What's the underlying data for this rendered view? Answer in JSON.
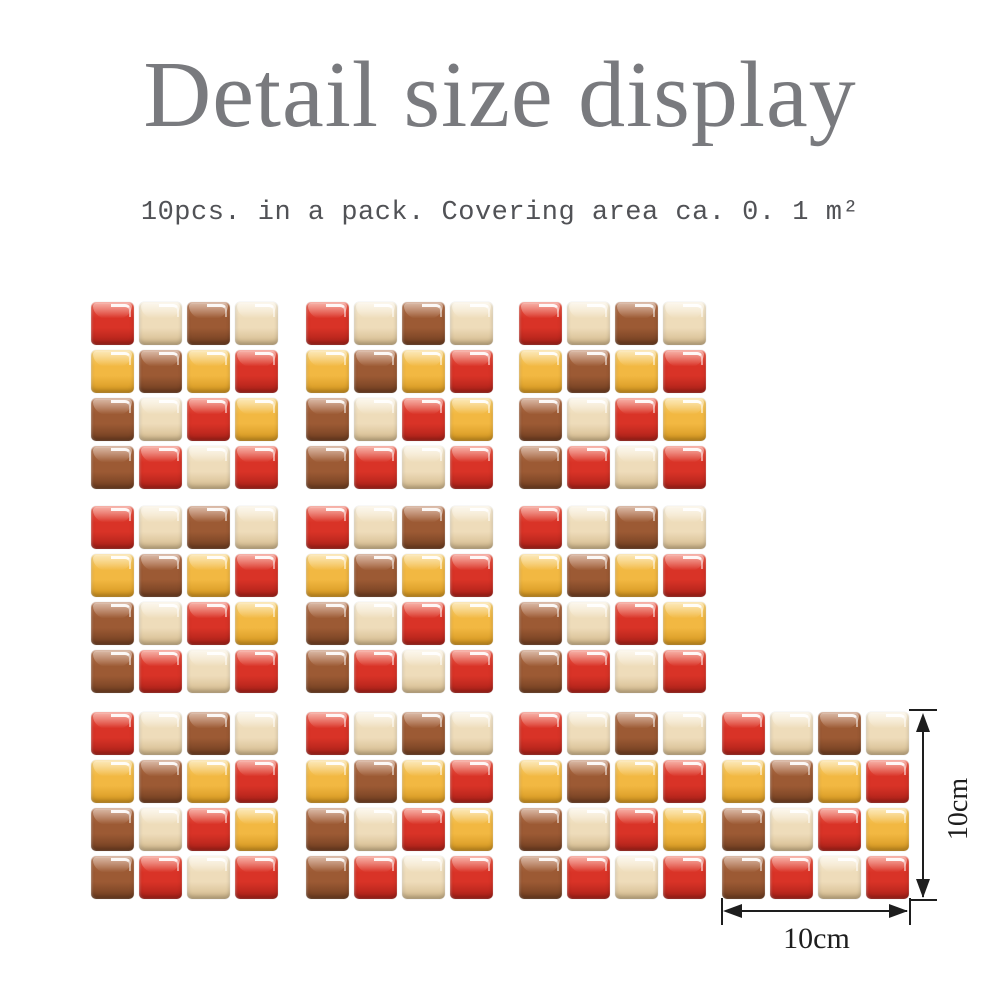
{
  "title": "Detail size display",
  "subtitle": "10pcs. in a pack. Covering area ca. 0. 1 m²",
  "dimensions": {
    "width_label": "10cm",
    "height_label": "10cm"
  },
  "mosaic": {
    "sheet_count": 10,
    "grid": "4x4",
    "pattern": [
      [
        "red",
        "cream",
        "brown",
        "cream"
      ],
      [
        "yellow",
        "brown",
        "yellow",
        "red"
      ],
      [
        "brown",
        "cream",
        "red",
        "yellow"
      ],
      [
        "brown",
        "red",
        "cream",
        "red"
      ]
    ],
    "tile_colors": {
      "red": {
        "light": "#ef5f4c",
        "base": "#d93327",
        "dark": "#a92018"
      },
      "cream": {
        "light": "#f9efd9",
        "base": "#eedcba",
        "dark": "#d2b88b"
      },
      "brown": {
        "light": "#b4714a",
        "base": "#9c5a34",
        "dark": "#6f3d20"
      },
      "yellow": {
        "light": "#f9d170",
        "base": "#f2b842",
        "dark": "#d2941e"
      }
    }
  },
  "text_colors": {
    "title": "#797a7e",
    "subtitle": "#515256",
    "dimension": "#1e1e1e"
  }
}
